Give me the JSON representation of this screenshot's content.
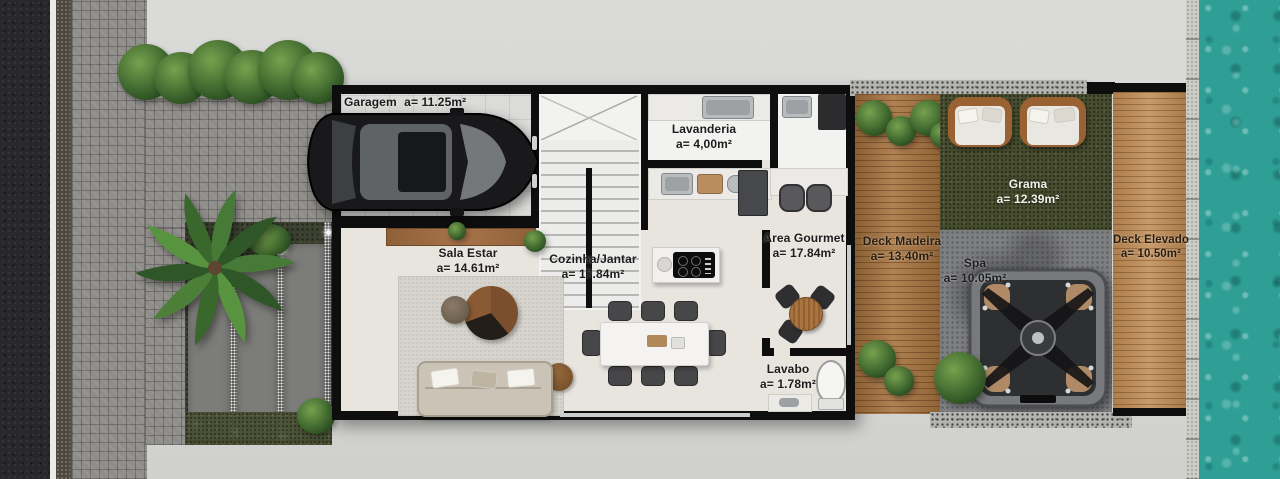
{
  "rooms": [
    {
      "name": "Garagem",
      "area": "a= 11.25m²"
    },
    {
      "name": "Lavanderia",
      "area": "a= 4,00m²"
    },
    {
      "name": "Sala Estar",
      "area": "a= 14.61m²"
    },
    {
      "name": "Cozinha/Jantar",
      "area": "a= 17.84m²"
    },
    {
      "name": "Area Gourmet",
      "area": "a= 17.84m²"
    },
    {
      "name": "Deck Madeira",
      "area": "a= 13.40m²"
    },
    {
      "name": "Grama",
      "area": "a= 12.39m²"
    },
    {
      "name": "Deck Elevado",
      "area": "a= 10.50m²"
    },
    {
      "name": "Spa",
      "area": "a= 10.05m²"
    },
    {
      "name": "Lavabo",
      "area": "a= 1.78m²"
    }
  ],
  "objects": [
    "car",
    "staircase",
    "laundry-sink",
    "kitchen-counter",
    "kitchen-island-cooktop",
    "refrigerator",
    "bar-stools",
    "sofa",
    "coffee-tables",
    "dining-table-8-chairs",
    "gourmet-table-3-chairs",
    "toilet",
    "washbasin",
    "spa-hot-tub",
    "sun-loungers",
    "palm-tree",
    "hedge-shrubs",
    "garden-step-plates",
    "swimming-pool"
  ],
  "colors": {
    "pool_water": "#2F9F96",
    "deck_wood": "#A8743F",
    "elevated_deck_wood": "#C18C55",
    "grass": "#474E2F",
    "asphalt": "#28282A",
    "paver": "#908E8B",
    "concrete": "#D8D8D6",
    "wall": "#0E0E0F",
    "floor": "#E8E5DF",
    "label_dark": "#1C1C1C",
    "label_light": "#F0F1EA"
  }
}
